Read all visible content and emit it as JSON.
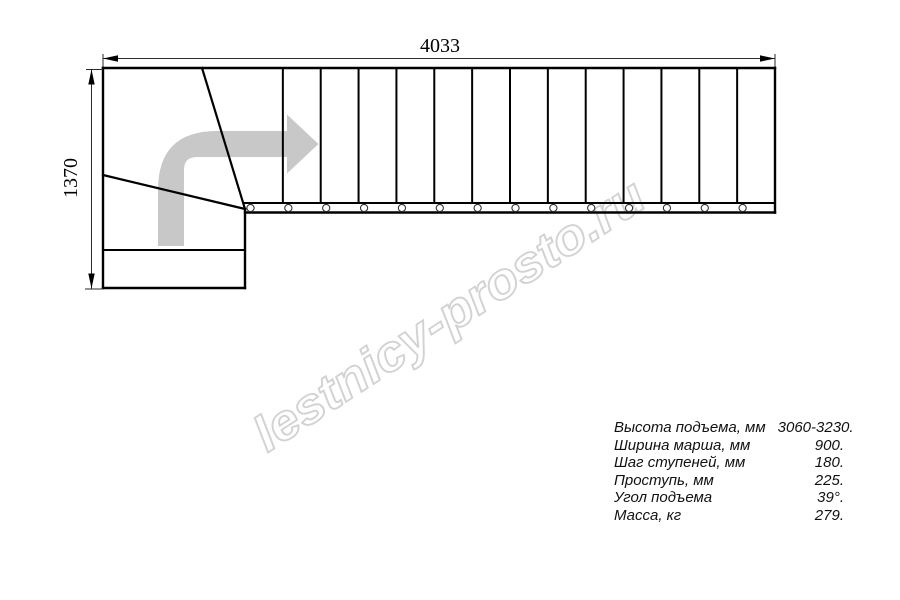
{
  "watermark": {
    "text": "lestnicy-prosto.ru"
  },
  "drawing": {
    "dimensions": {
      "width_label": "4033",
      "height_label": "1370"
    },
    "stair": {
      "type": "L-shaped staircase plan with winder turn",
      "straight_tread_count": 14,
      "bolt_count": 14,
      "direction_arrow": "up-then-right"
    },
    "colors": {
      "line": "#000000",
      "dimension_line": "#2a2a2a",
      "arrow_gray": "#c8c8c8",
      "watermark_gray": "#d2d2d2"
    }
  },
  "specs": {
    "rows": [
      {
        "label": "Высота подъема, мм",
        "value": "3060-3230."
      },
      {
        "label": "Ширина марша, мм",
        "value": "900."
      },
      {
        "label": "Шаг ступеней, мм",
        "value": "180."
      },
      {
        "label": "Проступь, мм",
        "value": "225."
      },
      {
        "label": "Угол подъема",
        "value": "39°."
      },
      {
        "label": "Масса, кг",
        "value": "279."
      }
    ]
  }
}
